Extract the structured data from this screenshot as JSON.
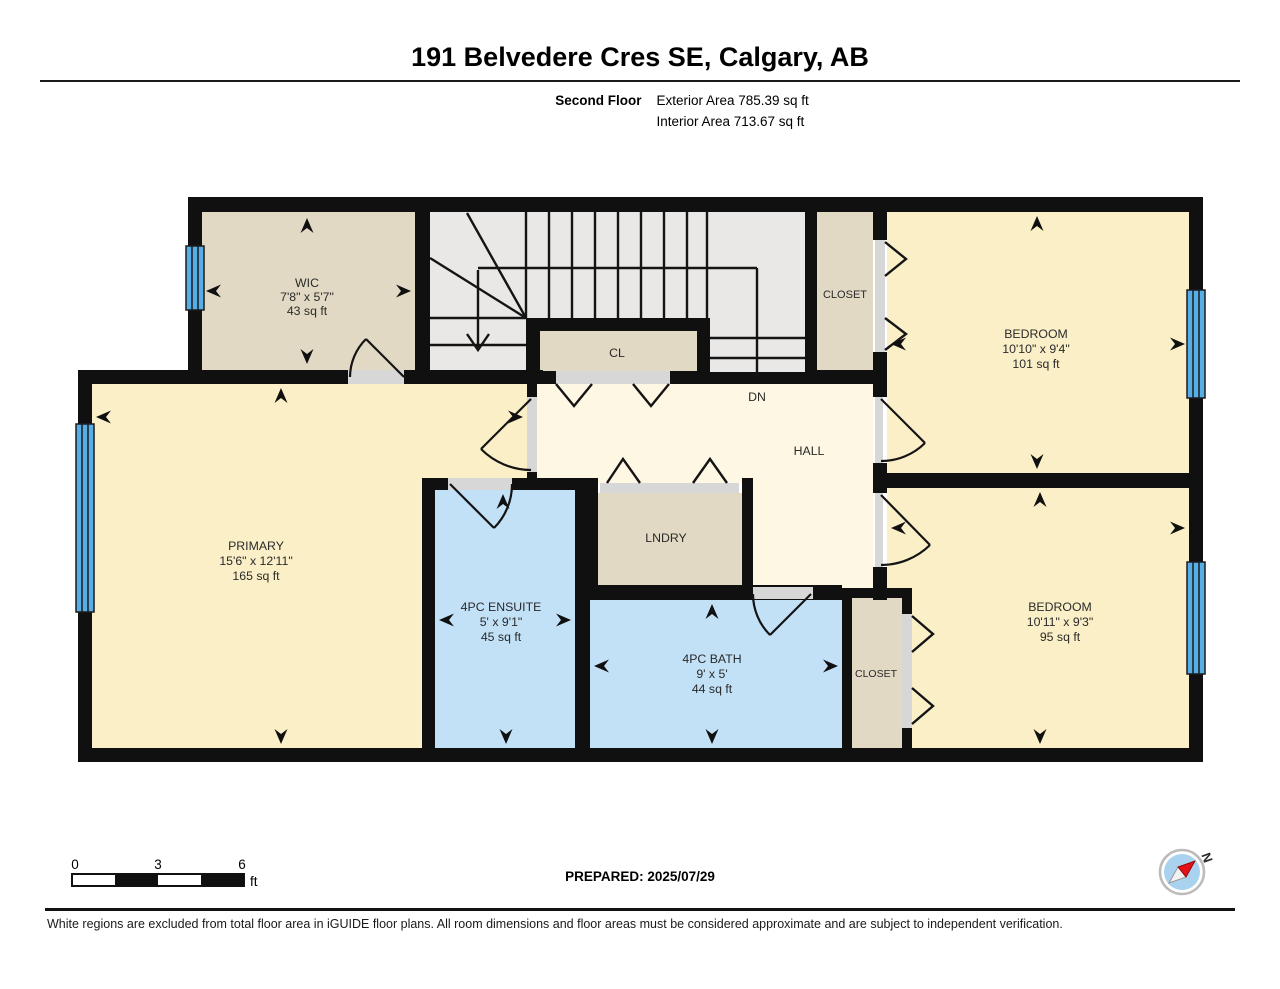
{
  "header": {
    "title": "191 Belvedere Cres SE, Calgary, AB",
    "floor_label": "Second Floor",
    "exterior_area": "Exterior Area 785.39 sq ft",
    "interior_area": "Interior Area 713.67 sq ft"
  },
  "rooms": {
    "wic": {
      "name": "WIC",
      "dims": "7'8\" x 5'7\"",
      "area": "43 sq ft"
    },
    "cl": {
      "name": "CL"
    },
    "closet_top": {
      "name": "CLOSET"
    },
    "bedroom_top": {
      "name": "BEDROOM",
      "dims": "10'10\" x 9'4\"",
      "area": "101 sq ft"
    },
    "stairs": {
      "dn_label": "DN"
    },
    "hall": {
      "name": "HALL"
    },
    "primary": {
      "name": "PRIMARY",
      "dims": "15'6\" x 12'11\"",
      "area": "165 sq ft"
    },
    "lndry": {
      "name": "LNDRY"
    },
    "ensuite": {
      "name": "4PC ENSUITE",
      "dims": "5' x 9'1\"",
      "area": "45 sq ft"
    },
    "bath": {
      "name": "4PC BATH",
      "dims": "9' x 5'",
      "area": "44 sq ft"
    },
    "closet_bottom": {
      "name": "CLOSET"
    },
    "bedroom_bottom": {
      "name": "BEDROOM",
      "dims": "10'11\" x 9'3\"",
      "area": "95 sq ft"
    }
  },
  "footer": {
    "scale": {
      "labels": [
        "0",
        "3",
        "6"
      ],
      "unit": "ft"
    },
    "prepared": "PREPARED: 2025/07/29",
    "compass_n": "N",
    "disclaimer": "White regions are excluded from total floor area in iGUIDE floor plans. All room dimensions and floor areas must be considered approximate and are subject to independent verification."
  },
  "colors": {
    "wall": "#101010",
    "bedroom_yellow": "#fbefc8",
    "hall_cream": "#fdf7e3",
    "closet_beige": "#e2d9c4",
    "stairs_gray": "#e9e8e6",
    "bath_blue": "#c2e1f7",
    "window_blue": "#57ade6",
    "door_sill": "#d7d7d7",
    "compass_red": "#e31219"
  }
}
